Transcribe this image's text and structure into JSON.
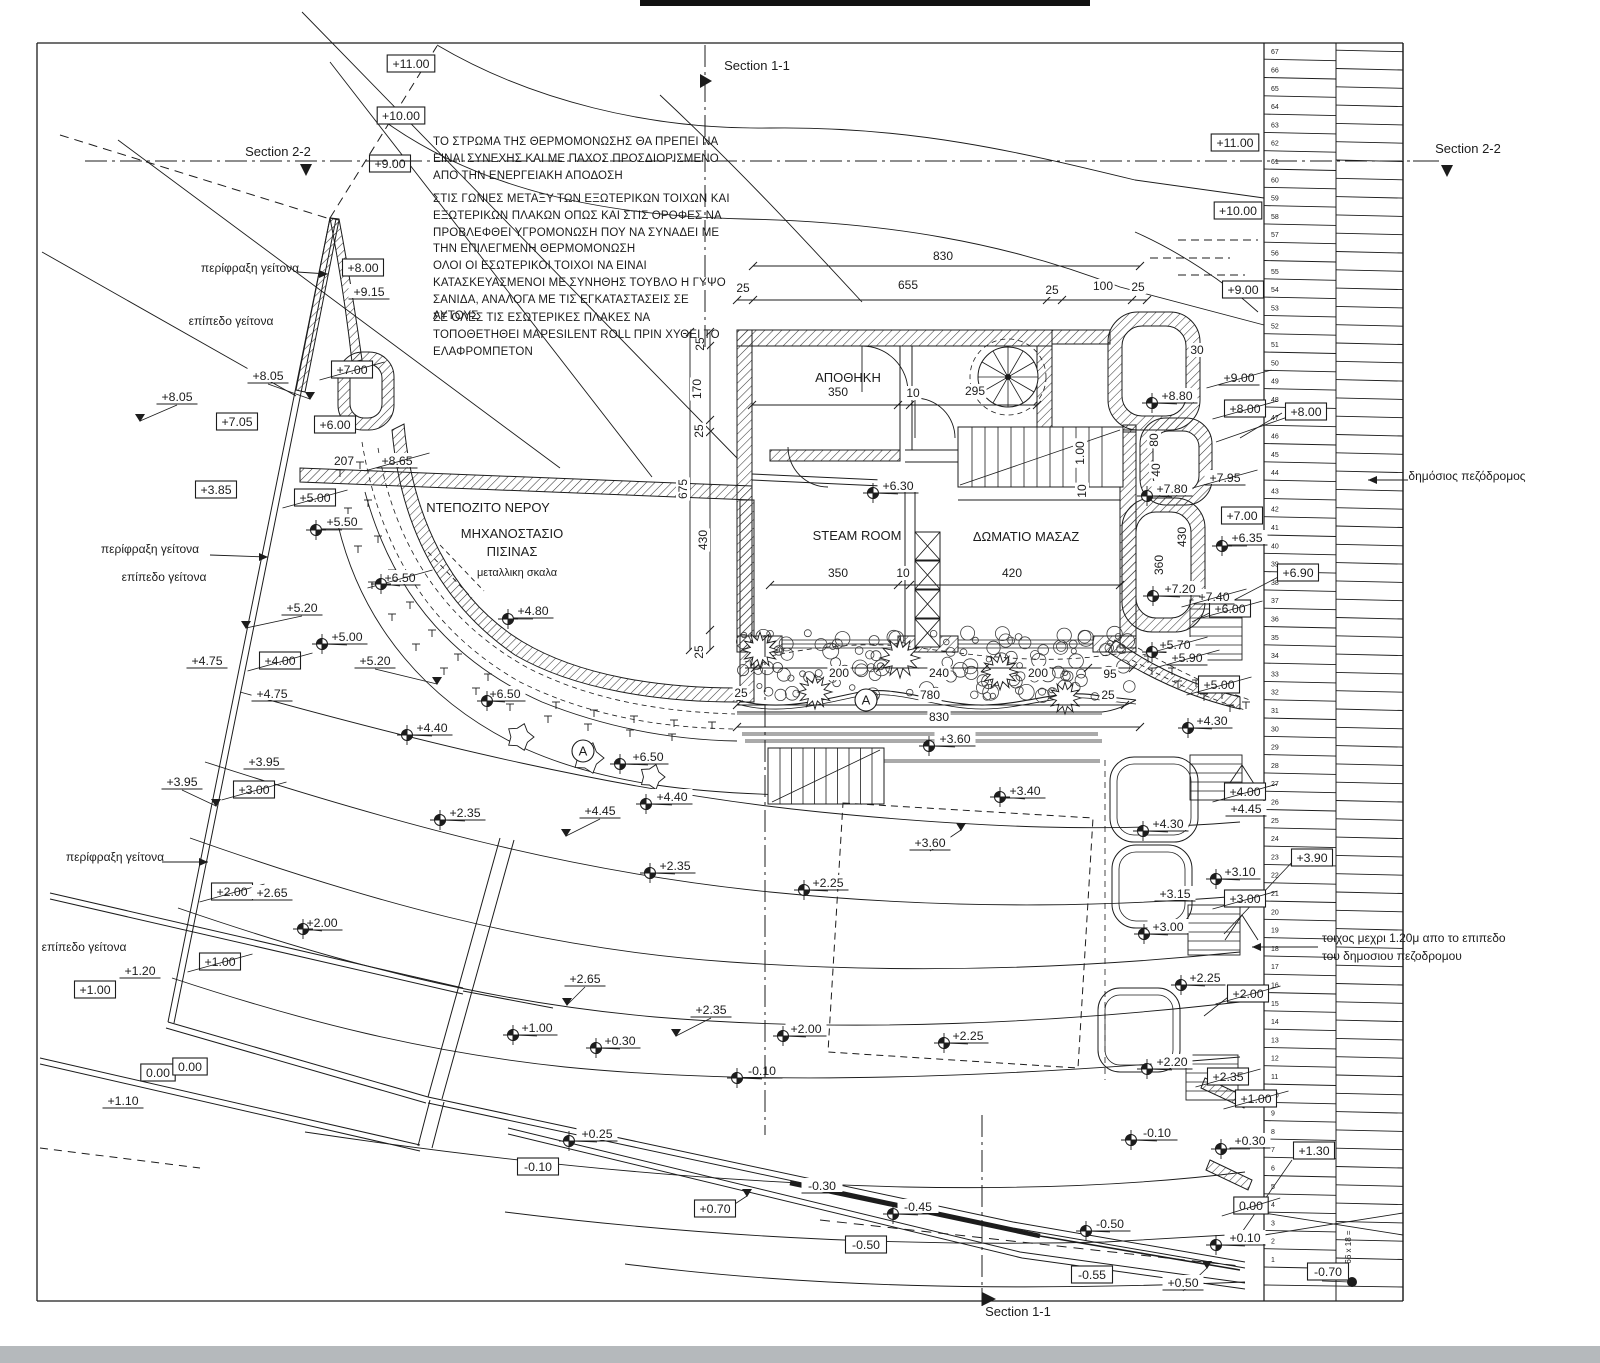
{
  "meta": {
    "title": "Site plan drawing",
    "ink": "#1c1c1c",
    "scan_bar": "#b5b9bc"
  },
  "notes": [
    "ΤΟ ΣΤΡΩΜΑ ΤΗΣ ΘΕΡΜΟΜΟΝΩΣΗΣ ΘΑ ΠΡΕΠΕΙ ΝΑ ΕΙΝΑΙ ΣΥΝΕΧΗΣ ΚΑΙ ΜΕ ΠΑΧΟΣ ΠΡΟΣΔΙΟΡΙΣΜΕΝΟ ΑΠΟ ΤΗΝ ΕΝΕΡΓΕΙΑΚΗ ΑΠΟΔΟΣΗ",
    "ΣΤΙΣ ΓΩΝΙΕΣ ΜΕΤΑΞΥ ΤΩΝ ΕΞΩΤΕΡΙΚΩΝ ΤΟΙΧΩΝ ΚΑΙ ΕΞΩΤΕΡΙΚΩΝ ΠΛΑΚΩΝ ΟΠΩΣ ΚΑΙ ΣΤΙΣ ΟΡΟΦΕΣ ΝΑ ΠΡΟΒΛΕΦΘΕΙ ΥΓΡΟΜΟΝΩΣΗ ΠΟΥ ΝΑ ΣΥΝΑΔΕΙ ΜΕ ΤΗΝ ΕΠΙΛΕΓΜΕΝΗ ΘΕΡΜΟΜΟΝΩΣΗ",
    "ΟΛΟΙ ΟΙ ΕΣΩΤΕΡΙΚΟΙ ΤΟΙΧΟΙ ΝΑ ΕΙΝΑΙ ΚΑΤΑΣΚΕΥΑΣΜΕΝΟΙ ΜΕ ΣΥΝΗΘΗΣ ΤΟΥΒΛΟ Η ΓΥΨΟ ΣΑΝΙΔΑ, ΑΝΑΛΟΓΑ ΜΕ ΤΙΣ ΕΓΚΑΤΑΣΤΑΣΕΙΣ ΣΕ ΑΥΤΟΥΣ",
    "ΣΕ ΟΛΕΣ ΤΙΣ ΕΣΩΤΕΡΙΚΕΣ ΠΛΑΚΕΣ ΝΑ ΤΟΠΟΘΕΤΗΘΕΙ MAPESILENT ROLL ΠΡΙΝ ΧΥΘΕΙ ΤΟ ΕΛΑΦΡΟΜΠΕΤΟΝ"
  ],
  "sections": {
    "top": "Section 1-1",
    "bottom": "Section 1-1",
    "left": "Section 2-2",
    "right": "Section 2-2"
  },
  "annotations": [
    {
      "t": "περίφραξη γείτονα",
      "x": 250,
      "y": 272,
      "arrow": [
        297,
        272,
        328,
        274
      ]
    },
    {
      "t": "επίπεδο γείτονα",
      "x": 231,
      "y": 325
    },
    {
      "t": "περίφραξη γείτονα",
      "x": 150,
      "y": 553,
      "arrow": [
        210,
        555,
        268,
        557
      ]
    },
    {
      "t": "επίπεδο γείτονα",
      "x": 164,
      "y": 581
    },
    {
      "t": "περίφραξη γείτονα",
      "x": 115,
      "y": 861,
      "arrow": [
        162,
        862,
        208,
        862
      ]
    },
    {
      "t": "επίπεδο γείτονα",
      "x": 84,
      "y": 951
    },
    {
      "t": "δημόσιος πεζόδρομος",
      "x": 1467,
      "y": 480,
      "arrowleft": [
        1408,
        480,
        1368,
        480
      ]
    },
    {
      "t": "τοιχος μεχρι 1.20μ απο το επιπεδο",
      "x": 1322,
      "y": 942,
      "anchor": "start"
    },
    {
      "t": "του δημοσιου πεζοδρομου",
      "x": 1322,
      "y": 960,
      "anchor": "start"
    }
  ],
  "rooms": [
    {
      "t": "ΑΠΟΘΗΚΗ",
      "x": 848,
      "y": 382,
      "fs": 13
    },
    {
      "t": "STEAM ROOM",
      "x": 857,
      "y": 540,
      "fs": 13
    },
    {
      "t": "ΔΩΜΑΤΙΟ ΜΑΣΑΖ",
      "x": 1026,
      "y": 541,
      "fs": 13
    },
    {
      "t": "ΝΤΕΠΟΖΙΤΟ ΝΕΡΟΥ",
      "x": 488,
      "y": 512,
      "fs": 13
    },
    {
      "t": "ΜΗΧΑΝΟΣΤΑΣΙΟ",
      "x": 512,
      "y": 538,
      "fs": 13
    },
    {
      "t": "ΠΙΣΙΝΑΣ",
      "x": 512,
      "y": 556,
      "fs": 13
    },
    {
      "t": "μεταλλικη σκαλα",
      "x": 517,
      "y": 576,
      "fs": 11
    }
  ],
  "area_markers": [
    {
      "t": "A",
      "x": 583,
      "y": 751
    },
    {
      "t": "A",
      "x": 866,
      "y": 700
    }
  ],
  "dimensions": [
    {
      "t": "830",
      "x": 943,
      "y": 260
    },
    {
      "t": "25",
      "x": 743,
      "y": 292
    },
    {
      "t": "655",
      "x": 908,
      "y": 289
    },
    {
      "t": "25",
      "x": 1052,
      "y": 294
    },
    {
      "t": "100",
      "x": 1103,
      "y": 290
    },
    {
      "t": "25",
      "x": 1138,
      "y": 291
    },
    {
      "t": "350",
      "x": 838,
      "y": 396
    },
    {
      "t": "10",
      "x": 913,
      "y": 397
    },
    {
      "t": "295",
      "x": 975,
      "y": 395
    },
    {
      "t": "350",
      "x": 838,
      "y": 577
    },
    {
      "t": "10",
      "x": 903,
      "y": 577
    },
    {
      "t": "420",
      "x": 1012,
      "y": 577
    },
    {
      "t": "200",
      "x": 839,
      "y": 677
    },
    {
      "t": "240",
      "x": 939,
      "y": 677
    },
    {
      "t": "200",
      "x": 1038,
      "y": 677
    },
    {
      "t": "95",
      "x": 1110,
      "y": 678
    },
    {
      "t": "25",
      "x": 741,
      "y": 697
    },
    {
      "t": "25",
      "x": 1108,
      "y": 699
    },
    {
      "t": "780",
      "x": 930,
      "y": 699
    },
    {
      "t": "830",
      "x": 939,
      "y": 721
    },
    {
      "t": "207",
      "x": 344,
      "y": 465
    },
    {
      "t": "30",
      "x": 1197,
      "y": 354
    },
    {
      "t": "675",
      "x": 687,
      "y": 489,
      "r": 1
    },
    {
      "t": "25",
      "x": 704,
      "y": 344,
      "r": 1
    },
    {
      "t": "170",
      "x": 701,
      "y": 389,
      "r": 1
    },
    {
      "t": "25",
      "x": 703,
      "y": 431,
      "r": 1
    },
    {
      "t": "430",
      "x": 707,
      "y": 540,
      "r": 1
    },
    {
      "t": "25",
      "x": 703,
      "y": 652,
      "r": 1
    },
    {
      "t": "80",
      "x": 1158,
      "y": 440,
      "r": 1
    },
    {
      "t": "40",
      "x": 1160,
      "y": 470,
      "r": 1
    },
    {
      "t": "430",
      "x": 1186,
      "y": 537,
      "r": 1
    },
    {
      "t": "360",
      "x": 1163,
      "y": 565,
      "r": 1
    },
    {
      "t": "1.00",
      "x": 1084,
      "y": 453,
      "r": 1
    },
    {
      "t": "10",
      "x": 1086,
      "y": 491,
      "r": 1
    }
  ],
  "levels": [
    [
      411,
      64,
      "+11.00",
      "b"
    ],
    [
      401,
      116,
      "+10.00",
      "b"
    ],
    [
      390,
      164,
      "+9.00",
      "b"
    ],
    [
      363,
      268,
      "+8.00",
      "b"
    ],
    [
      369,
      292,
      "+9.15",
      "p"
    ],
    [
      352,
      370,
      "+7.00",
      "bs"
    ],
    [
      268,
      376,
      "+8.05",
      "p",
      310,
      399,
      "v"
    ],
    [
      177,
      397,
      "+8.05",
      "p",
      140,
      421,
      "v"
    ],
    [
      237,
      422,
      "+7.05",
      "b"
    ],
    [
      335,
      425,
      "+6.00",
      "b"
    ],
    [
      397,
      461,
      "+8.65",
      "ps"
    ],
    [
      216,
      490,
      "+3.85",
      "b"
    ],
    [
      315,
      498,
      "+5.00",
      "bs"
    ],
    [
      342,
      522,
      "+5.50",
      "p",
      316,
      530,
      "c"
    ],
    [
      400,
      578,
      "+6.50",
      "ps",
      381,
      584,
      "c"
    ],
    [
      302,
      608,
      "+5.20",
      "p",
      246,
      628,
      "v"
    ],
    [
      347,
      637,
      "+5.00",
      "p",
      322,
      644,
      "c"
    ],
    [
      375,
      661,
      "+5.20",
      "p",
      437,
      684,
      "v"
    ],
    [
      207,
      661,
      "+4.75",
      "p"
    ],
    [
      280,
      661,
      "+4.00",
      "bs"
    ],
    [
      272,
      694,
      "+4.75",
      "p"
    ],
    [
      533,
      611,
      "+4.80",
      "p",
      508,
      619,
      "c"
    ],
    [
      505,
      694,
      "+6.50",
      "p",
      487,
      701,
      "c"
    ],
    [
      648,
      757,
      "+6.50",
      "p",
      620,
      764,
      "c"
    ],
    [
      432,
      728,
      "+4.40",
      "p",
      407,
      735,
      "c"
    ],
    [
      182,
      782,
      "+3.95",
      "p",
      216,
      806,
      "v"
    ],
    [
      264,
      762,
      "+3.95",
      "p"
    ],
    [
      254,
      790,
      "+3.00",
      "bs"
    ],
    [
      465,
      813,
      "+2.35",
      "p",
      440,
      820,
      "c"
    ],
    [
      675,
      866,
      "+2.35",
      "p",
      650,
      873,
      "c"
    ],
    [
      600,
      811,
      "+4.45",
      "p",
      566,
      836,
      "v"
    ],
    [
      672,
      797,
      "+4.40",
      "p",
      646,
      804,
      "c"
    ],
    [
      232,
      892,
      "+2.00",
      "bs"
    ],
    [
      272,
      893,
      "+2.65",
      "p"
    ],
    [
      322,
      923,
      "+2.00",
      "p",
      303,
      929,
      "c"
    ],
    [
      140,
      971,
      "+1.20",
      "p"
    ],
    [
      95,
      990,
      "+1.00",
      "b"
    ],
    [
      220,
      962,
      "+1.00",
      "bs"
    ],
    [
      123,
      1101,
      "+1.10",
      "p"
    ],
    [
      158,
      1073,
      "0.00",
      "b"
    ],
    [
      190,
      1067,
      "0.00",
      "b"
    ],
    [
      537,
      1028,
      "+1.00",
      "p",
      513,
      1035,
      "c"
    ],
    [
      620,
      1041,
      "+0.30",
      "p",
      596,
      1048,
      "c"
    ],
    [
      585,
      979,
      "+2.65",
      "p",
      567,
      1005,
      "v"
    ],
    [
      711,
      1010,
      "+2.35",
      "p",
      676,
      1036,
      "v"
    ],
    [
      806,
      1029,
      "+2.00",
      "p",
      783,
      1036,
      "c"
    ],
    [
      828,
      883,
      "+2.25",
      "p",
      804,
      890,
      "c"
    ],
    [
      968,
      1036,
      "+2.25",
      "p",
      944,
      1043,
      "c"
    ],
    [
      762,
      1071,
      "-0.10",
      "p",
      737,
      1078,
      "c"
    ],
    [
      597,
      1134,
      "+0.25",
      "p",
      569,
      1141,
      "c"
    ],
    [
      538,
      1167,
      "-0.10",
      "b"
    ],
    [
      930,
      843,
      "+3.60",
      "p",
      961,
      830,
      "v"
    ],
    [
      955,
      739,
      "+3.60",
      "p",
      929,
      746,
      "c"
    ],
    [
      1025,
      791,
      "+3.40",
      "p",
      1000,
      797,
      "c"
    ],
    [
      898,
      486,
      "+6.30",
      "p",
      873,
      493,
      "c"
    ],
    [
      822,
      1186,
      "-0.30",
      "p"
    ],
    [
      715,
      1209,
      "+0.70",
      "b",
      747,
      1196,
      "v"
    ],
    [
      918,
      1207,
      "-0.45",
      "p",
      893,
      1214,
      "c"
    ],
    [
      866,
      1245,
      "-0.50",
      "b"
    ],
    [
      1110,
      1224,
      "-0.50",
      "p",
      1086,
      1231,
      "c"
    ],
    [
      1092,
      1275,
      "-0.55",
      "b"
    ],
    [
      1183,
      1283,
      "+0.50",
      "p",
      1207,
      1268,
      "v"
    ],
    [
      1157,
      1133,
      "-0.10",
      "p",
      1131,
      1140,
      "c"
    ],
    [
      1250,
      1141,
      "+0.30",
      "p",
      1221,
      1149,
      "c"
    ],
    [
      1245,
      1238,
      "+0.10",
      "p",
      1216,
      1245,
      "c"
    ],
    [
      1251,
      1206,
      "0.00",
      "bs"
    ],
    [
      1314,
      1151,
      "+1.30",
      "b"
    ],
    [
      1328,
      1272,
      "-0.70",
      "b"
    ],
    [
      1228,
      1077,
      "+2.35",
      "bs"
    ],
    [
      1256,
      1099,
      "+1.00",
      "bs"
    ],
    [
      1248,
      994,
      "+2.00",
      "bs"
    ],
    [
      1172,
      1062,
      "+2.20",
      "p",
      1147,
      1069,
      "c"
    ],
    [
      1205,
      978,
      "+2.25",
      "p",
      1181,
      985,
      "c"
    ],
    [
      1168,
      927,
      "+3.00",
      "p",
      1144,
      934,
      "c"
    ],
    [
      1175,
      894,
      "+3.15",
      "p"
    ],
    [
      1245,
      899,
      "+3.00",
      "bs"
    ],
    [
      1240,
      872,
      "+3.10",
      "p",
      1216,
      879,
      "c"
    ],
    [
      1312,
      858,
      "+3.90",
      "b"
    ],
    [
      1168,
      824,
      "+4.30",
      "p",
      1143,
      831,
      "c"
    ],
    [
      1246,
      809,
      "+4.45",
      "p"
    ],
    [
      1245,
      792,
      "+4.00",
      "bs"
    ],
    [
      1212,
      721,
      "+4.30",
      "p",
      1188,
      728,
      "c"
    ],
    [
      1219,
      685,
      "+5.00",
      "bs"
    ],
    [
      1175,
      645,
      "+5.70",
      "ps",
      1152,
      652,
      "c"
    ],
    [
      1187,
      658,
      "+5.90",
      "ps"
    ],
    [
      1230,
      609,
      "+6.00",
      "bs"
    ],
    [
      1214,
      597,
      "+7.40",
      "ps"
    ],
    [
      1180,
      589,
      "+7.20",
      "p",
      1153,
      596,
      "c"
    ],
    [
      1298,
      573,
      "+6.90",
      "b"
    ],
    [
      1247,
      538,
      "+6.35",
      "p",
      1222,
      546,
      "c"
    ],
    [
      1242,
      516,
      "+7.00",
      "b"
    ],
    [
      1172,
      489,
      "+7.80",
      "p",
      1147,
      496,
      "c"
    ],
    [
      1225,
      478,
      "+7.95",
      "ps"
    ],
    [
      1177,
      396,
      "+8.80",
      "p",
      1152,
      403,
      "c"
    ],
    [
      1239,
      378,
      "+9.00",
      "ps"
    ],
    [
      1245,
      409,
      "+8.00",
      "bs"
    ],
    [
      1306,
      412,
      "+8.00",
      "b"
    ],
    [
      1243,
      290,
      "+9.00",
      "b"
    ],
    [
      1238,
      211,
      "+10.00",
      "b"
    ],
    [
      1235,
      143,
      "+11.00",
      "b"
    ]
  ],
  "stair_strip": {
    "first": 1,
    "last": 67,
    "riser_note": "66 x 18 ="
  }
}
